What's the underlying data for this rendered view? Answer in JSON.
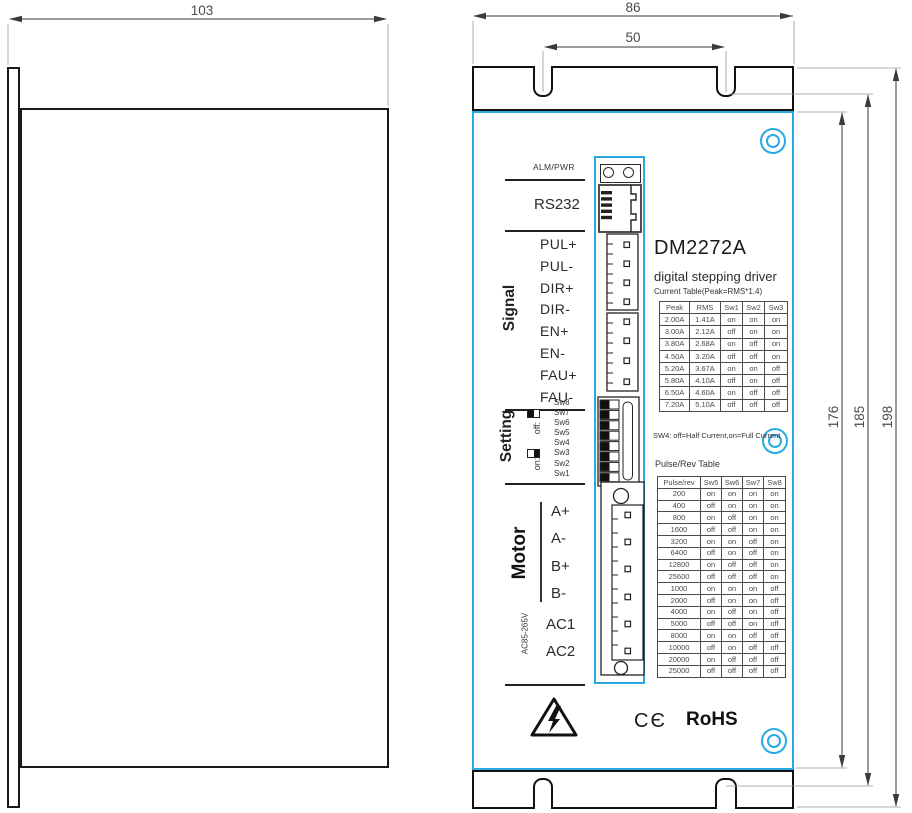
{
  "drawing": {
    "dimensions": {
      "side_width": "103",
      "front_width": "86",
      "slot_span": "50",
      "body_height": "176",
      "slot_height": "185",
      "total_height": "198"
    },
    "panel": {
      "led_label": "ALM/PWR",
      "rs232_label": "RS232",
      "signal": {
        "title": "Signal",
        "pins": [
          "PUL+",
          "PUL-",
          "DIR+",
          "DIR-",
          "EN+",
          "EN-",
          "FAU+",
          "FAU-"
        ]
      },
      "setting": {
        "title": "Setting",
        "off_label": "off:",
        "on_label": "on:",
        "switches": [
          "Sw8",
          "Sw7",
          "Sw6",
          "Sw5",
          "Sw4",
          "Sw3",
          "Sw2",
          "Sw1"
        ]
      },
      "motor": {
        "title": "Motor",
        "pins": [
          "A+",
          "A-",
          "B+",
          "B-"
        ]
      },
      "power": {
        "title": "AC85-265V",
        "pins": [
          "AC1",
          "AC2"
        ]
      },
      "model": "DM2272A",
      "subtitle": "digital stepping driver",
      "current_table": {
        "caption": "Current Table(Peak=RMS*1.4)",
        "headers": [
          "Peak",
          "RMS",
          "Sw1",
          "Sw2",
          "Sw3"
        ],
        "rows": [
          [
            "2.00A",
            "1.41A",
            "on",
            "on",
            "on"
          ],
          [
            "3.00A",
            "2.12A",
            "off",
            "on",
            "on"
          ],
          [
            "3.80A",
            "2.68A",
            "on",
            "off",
            "on"
          ],
          [
            "4.50A",
            "3.20A",
            "off",
            "off",
            "on"
          ],
          [
            "5.20A",
            "3.67A",
            "on",
            "on",
            "off"
          ],
          [
            "5.80A",
            "4.10A",
            "off",
            "on",
            "off"
          ],
          [
            "6.50A",
            "4.60A",
            "on",
            "off",
            "off"
          ],
          [
            "7.20A",
            "5.10A",
            "off",
            "off",
            "off"
          ]
        ]
      },
      "sw4_note": "SW4: off=Half Current,on=Full Current",
      "pulse_table": {
        "title": "Pulse/Rev Table",
        "headers": [
          "Pulse/rev",
          "Sw5",
          "Sw6",
          "Sw7",
          "Sw8"
        ],
        "rows": [
          [
            "200",
            "on",
            "on",
            "on",
            "on"
          ],
          [
            "400",
            "off",
            "on",
            "on",
            "on"
          ],
          [
            "800",
            "on",
            "off",
            "on",
            "on"
          ],
          [
            "1600",
            "off",
            "off",
            "on",
            "on"
          ],
          [
            "3200",
            "on",
            "on",
            "off",
            "on"
          ],
          [
            "6400",
            "off",
            "on",
            "off",
            "on"
          ],
          [
            "12800",
            "on",
            "off",
            "off",
            "on"
          ],
          [
            "25600",
            "off",
            "off",
            "off",
            "on"
          ],
          [
            "1000",
            "on",
            "on",
            "on",
            "off"
          ],
          [
            "2000",
            "off",
            "on",
            "on",
            "off"
          ],
          [
            "4000",
            "on",
            "off",
            "on",
            "off"
          ],
          [
            "5000",
            "off",
            "off",
            "on",
            "off"
          ],
          [
            "8000",
            "on",
            "on",
            "off",
            "off"
          ],
          [
            "10000",
            "off",
            "on",
            "off",
            "off"
          ],
          [
            "20000",
            "on",
            "off",
            "off",
            "off"
          ],
          [
            "25000",
            "off",
            "off",
            "off",
            "off"
          ]
        ]
      },
      "certifications": {
        "ce": "CЄ",
        "rohs": "RoHS"
      }
    },
    "colors": {
      "accent": "#29ABE2",
      "line": "#1a1a1a"
    }
  }
}
